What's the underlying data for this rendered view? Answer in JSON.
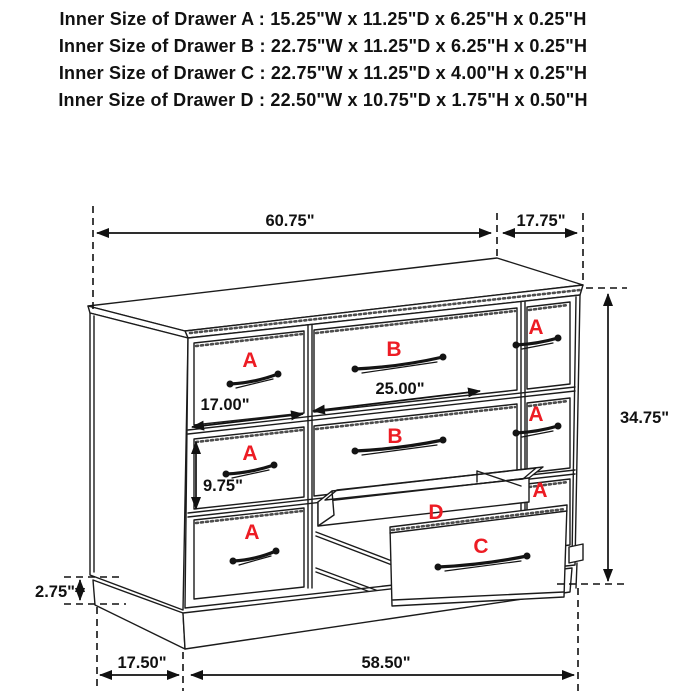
{
  "header": {
    "lines": [
      "Inner Size of Drawer A : 15.25\"W x 11.25\"D x 6.25\"H x 0.25\"H",
      "Inner Size of Drawer B : 22.75\"W x 11.25\"D x 6.25\"H x 0.25\"H",
      "Inner Size of Drawer C : 22.75\"W x 11.25\"D x 4.00\"H x 0.25\"H",
      "Inner Size of Drawer D : 22.50\"W x 10.75\"D x 1.75\"H x 0.50\"H"
    ]
  },
  "figure": {
    "drawer_labels": {
      "a": "A",
      "b": "B",
      "c": "C",
      "d": "D"
    },
    "dimensions": {
      "top_width": "60.75\"",
      "top_depth": "17.75\"",
      "height": "34.75\"",
      "drawer_a_width": "17.00\"",
      "drawer_b_width": "25.00\"",
      "drawer_a_height": "9.75\"",
      "base_height": "2.75\"",
      "base_depth": "17.50\"",
      "base_width": "58.50\""
    }
  },
  "colors": {
    "label_red": "#ed1c24",
    "line_black": "#1b1b1b",
    "background": "#ffffff"
  }
}
